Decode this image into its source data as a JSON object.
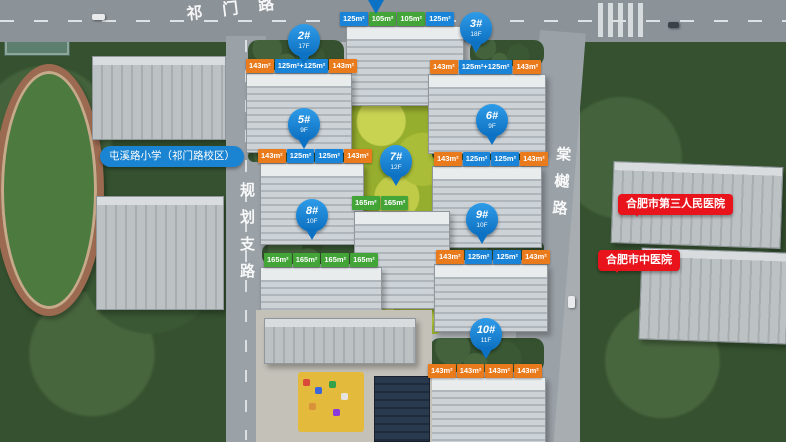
{
  "roads": {
    "top_name": "祁门路",
    "left_name": "规划支路",
    "right_name": "棠樾路"
  },
  "pois": {
    "school_label": "屯溪路小学（祁门路校区）",
    "hospital_1": "合肥市第三人民医院",
    "hospital_2": "合肥市中医院"
  },
  "pins": [
    {
      "label": "2#",
      "floors": "17F"
    },
    {
      "label": "3#",
      "floors": "18F"
    },
    {
      "label": "5#",
      "floors": "9F"
    },
    {
      "label": "6#",
      "floors": "9F"
    },
    {
      "label": "7#",
      "floors": "12F"
    },
    {
      "label": "8#",
      "floors": "10F"
    },
    {
      "label": "9#",
      "floors": "10F"
    },
    {
      "label": "10#",
      "floors": "11F"
    }
  ],
  "tag_rows": [
    {
      "building": "1",
      "tags": [
        {
          "text": "125m²",
          "color": "blue"
        },
        {
          "text": "105m²",
          "color": "green"
        },
        {
          "text": "105m²",
          "color": "green"
        },
        {
          "text": "125m²",
          "color": "blue"
        }
      ]
    },
    {
      "building": "2",
      "tags": [
        {
          "text": "143m²",
          "color": "orange"
        },
        {
          "text": "125m²+125m²",
          "color": "blue"
        },
        {
          "text": "143m²",
          "color": "orange"
        }
      ]
    },
    {
      "building": "3",
      "tags": [
        {
          "text": "143m²",
          "color": "orange"
        },
        {
          "text": "125m²+125m²",
          "color": "blue"
        },
        {
          "text": "143m²",
          "color": "orange"
        }
      ]
    },
    {
      "building": "5",
      "tags": [
        {
          "text": "143m²",
          "color": "orange"
        },
        {
          "text": "125m²",
          "color": "blue"
        },
        {
          "text": "125m²",
          "color": "blue"
        },
        {
          "text": "143m²",
          "color": "orange"
        }
      ]
    },
    {
      "building": "6",
      "tags": [
        {
          "text": "143m²",
          "color": "orange"
        },
        {
          "text": "125m²",
          "color": "blue"
        },
        {
          "text": "125m²",
          "color": "blue"
        },
        {
          "text": "143m²",
          "color": "orange"
        }
      ]
    },
    {
      "building": "7",
      "tags": [
        {
          "text": "165m²",
          "color": "green"
        },
        {
          "text": "165m²",
          "color": "green"
        }
      ]
    },
    {
      "building": "8",
      "tags": [
        {
          "text": "165m²",
          "color": "green"
        },
        {
          "text": "165m²",
          "color": "green"
        },
        {
          "text": "165m²",
          "color": "green"
        },
        {
          "text": "165m²",
          "color": "green"
        }
      ]
    },
    {
      "building": "9",
      "tags": [
        {
          "text": "143m²",
          "color": "orange"
        },
        {
          "text": "125m²",
          "color": "blue"
        },
        {
          "text": "125m²",
          "color": "blue"
        },
        {
          "text": "143m²",
          "color": "orange"
        }
      ]
    },
    {
      "building": "10",
      "tags": [
        {
          "text": "143m²",
          "color": "orange"
        },
        {
          "text": "143m²",
          "color": "orange"
        },
        {
          "text": "143m²",
          "color": "orange"
        },
        {
          "text": "143m²",
          "color": "orange"
        }
      ]
    }
  ],
  "colors": {
    "pin_blue": "#0d72c4",
    "tag_blue": "#1a85d8",
    "tag_green": "#43a437",
    "tag_orange": "#ea7b1c",
    "bubble_red": "#e8131b",
    "school_pill_blue": "#1b84d2"
  }
}
